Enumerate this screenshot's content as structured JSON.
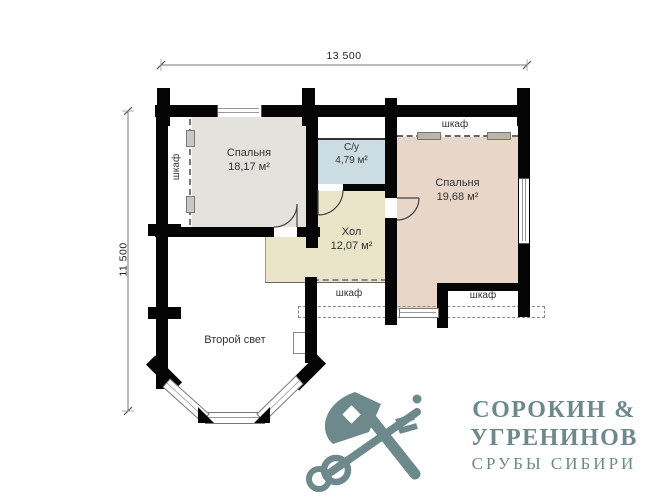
{
  "plan": {
    "dimensions": {
      "width_label": "13 500",
      "height_label": "11 500"
    },
    "rooms": [
      {
        "id": "bedroom-left",
        "name": "Спальня",
        "area": "18,17 м²"
      },
      {
        "id": "bathroom",
        "name": "С/у",
        "area": "4,79 м²"
      },
      {
        "id": "bedroom-right",
        "name": "Спальня",
        "area": "19,68 м²"
      },
      {
        "id": "hall",
        "name": "Хол",
        "area": "12,07 м²"
      }
    ],
    "labels": {
      "closet": "шкаф",
      "second_light": "Второй свет"
    },
    "colors": {
      "wall": "#050505",
      "bedroom_left_fill": "#e3e2dd",
      "bathroom_fill": "#cbdde3",
      "bedroom_right_fill": "#e8d6c8",
      "hall_fill": "#eae4c8",
      "logo": "#6d898c"
    }
  },
  "logo": {
    "line1": "СОРОКИН &",
    "line2": "УГРЕНИНОВ",
    "line3": "СРУБЫ СИБИРИ"
  }
}
